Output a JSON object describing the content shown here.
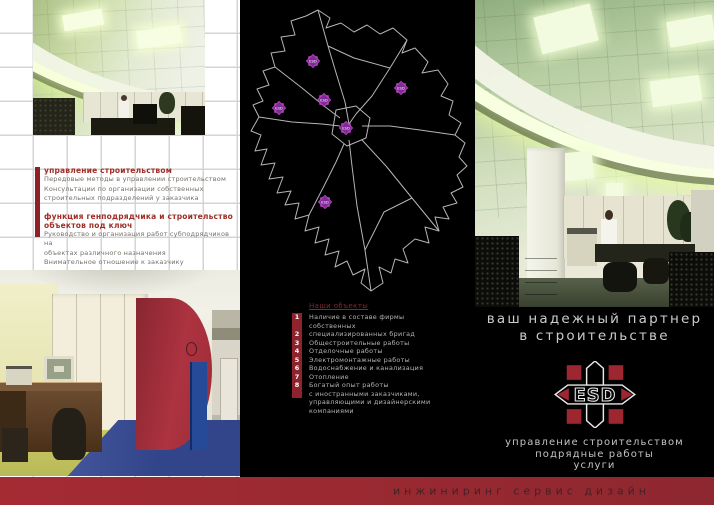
{
  "left_panel": {
    "section1": {
      "heading": "управление строительством",
      "body": [
        "Передовые методы в управлении строительством",
        "Консультации по организации собственных",
        "строительных подразделений у заказчика"
      ]
    },
    "section2": {
      "heading_line1": "функция генподрядчика и строительство",
      "heading_line2": "объектов под ключ",
      "body": [
        "Руководство и организация работ субподрядчиков на",
        "объектах различного назначения",
        "Внимательное отношение к заказчику"
      ]
    }
  },
  "map_panel": {
    "markers": [
      {
        "x": 69,
        "y": 55,
        "label": "ESD"
      },
      {
        "x": 157,
        "y": 82,
        "label": "ESD"
      },
      {
        "x": 80,
        "y": 94,
        "label": "ESD"
      },
      {
        "x": 35,
        "y": 102,
        "label": "ESD"
      },
      {
        "x": 102,
        "y": 122,
        "label": "ESD"
      },
      {
        "x": 81,
        "y": 196,
        "label": "ESD"
      }
    ],
    "objects_list": {
      "title": "Наши объекты",
      "rows": [
        {
          "num": "1",
          "text": "Наличие в составе фирмы"
        },
        {
          "num": "",
          "text": "собственных"
        },
        {
          "num": "2",
          "text": "специализированных бригад"
        },
        {
          "num": "3",
          "text": "Общестроительные работы"
        },
        {
          "num": "4",
          "text": "Отделочные работы"
        },
        {
          "num": "5",
          "text": "Электромонтажные работы"
        },
        {
          "num": "6",
          "text": "Водоснабжение и канализация"
        },
        {
          "num": "7",
          "text": "Отопление"
        },
        {
          "num": "8",
          "text": "Богатый опыт работы"
        },
        {
          "num": "",
          "text": "с иностранными заказчиками,"
        },
        {
          "num": "",
          "text": "управляющими и дизайнерскими"
        },
        {
          "num": "",
          "text": "компаниями"
        }
      ]
    }
  },
  "right_panel": {
    "tagline_line1": "ваш надежный партнер",
    "tagline_line2": "в строительстве",
    "logo_text": "ESD",
    "services": [
      "управление строительством",
      "подрядные работы",
      "услуги"
    ]
  },
  "footer": {
    "text": "инжиниринг сервис дизайн"
  },
  "colors": {
    "accent_red": "#9b2931",
    "bar_red": "#8e232e",
    "heading_red": "#9e2d26",
    "marker_magenta": "#a832b4",
    "map_line": "#b5b5b5",
    "list_text": "#b4b4b4",
    "tagline_gray": "#cbcbcb"
  }
}
